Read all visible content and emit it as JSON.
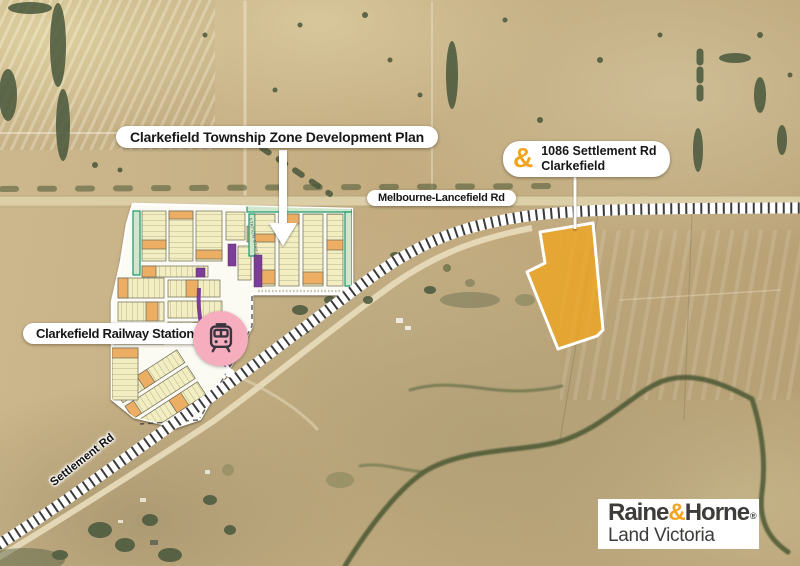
{
  "labels": {
    "plan_title": "Clarkefield Township Zone Development Plan",
    "property_marker": "&",
    "property_address_line1": "1086 Settlement Rd",
    "property_address_line2": "Clarkefield",
    "main_road": "Melbourne-Lancefield Rd",
    "station": "Clarkefield Railway Station",
    "settlement_road": "Settlement Rd"
  },
  "plan": {
    "station_street": "STATION STREET"
  },
  "logo": {
    "brand_1": "Raine",
    "amp": "&",
    "brand_2": "Horne",
    "registered": "®",
    "subtitle": "Land Victoria"
  },
  "colors": {
    "accent_orange": "#F2A41F",
    "parcel_fill": "#F0A51F",
    "station_pink": "#F6ADBE",
    "plan_teal": "#18996B",
    "plan_purple": "#7C3D95",
    "lot_cream": "#F2EEC2",
    "lot_orange": "#ECAE63"
  },
  "icons": {
    "train": "train-icon",
    "arrow": "arrow-down-icon",
    "ampersand": "raine-horne-ampersand-mark"
  }
}
